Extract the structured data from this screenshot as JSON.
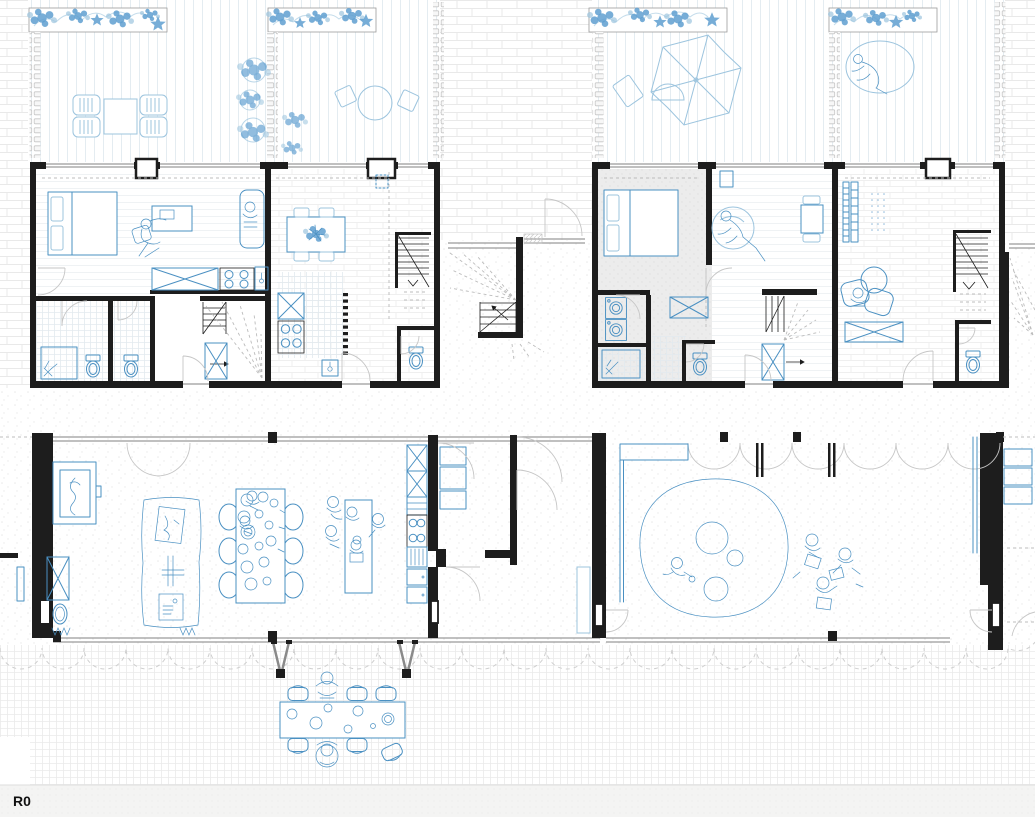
{
  "drawing": {
    "level_label": "R0"
  },
  "colors": {
    "wall_black": "#1d1d1d",
    "plan_blue": "#4a90c2",
    "light_blue": "#9cc4de",
    "pale_blue_fill": "#cfe3f1",
    "flower_blue": "#5f9fd0",
    "glazing_gray": "#9b9b9b",
    "door_gray": "#c6c6c6",
    "dash_gray": "#bcbcbc",
    "texture_gray": "#e9e9e9",
    "room_gray": "#ececec",
    "band_bg": "#f4f4f3"
  }
}
